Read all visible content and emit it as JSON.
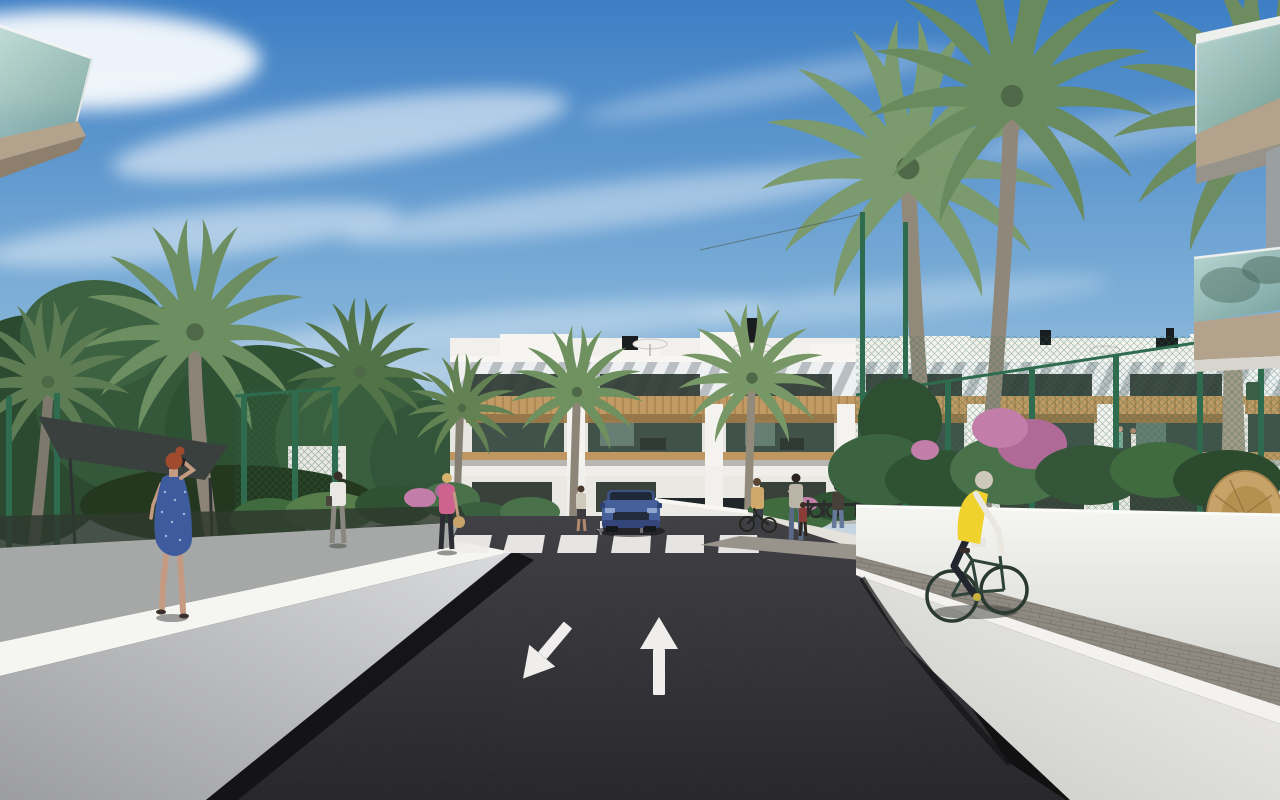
{
  "scene": {
    "type": "architectural-exterior-render",
    "description": "3D rendering of a modern white Mediterranean apartment complex seen down a dark asphalt access road. White retaining walls flank the road, palm trees and green mesh fences line both sides, a blue SUV exits a garage behind a zebra crosswalk, a cyclist in a yellow vest rides a paved path on the right, and pedestrians walk the landscaped paths.",
    "elements": [
      "blue-sky-with-cirrus-clouds",
      "apartment-building",
      "rooftop-pergola-slats",
      "wood-clad-balconies",
      "penthouse-volumes",
      "roof-umbrellas",
      "chimneys",
      "palm-trees",
      "green-mesh-fences",
      "shade-sail",
      "flowering-shrubs",
      "bougainvillea",
      "hanging-wicker-chair",
      "foreground-glass-balconies",
      "asphalt-road",
      "zebra-crosswalk",
      "lane-arrows",
      "blue-suv",
      "white-retaining-walls",
      "paver-cycle-path",
      "cyclist-yellow-vest",
      "woman-blue-dress-on-phone",
      "man-white-shirt",
      "woman-pink-top",
      "pedestrian-group-with-child",
      "woman-with-bicycle",
      "bike-racks",
      "green-bin"
    ],
    "road_markings": {
      "lane_arrows": [
        "toward-viewer-down-left",
        "away-from-viewer-up"
      ],
      "crosswalk_stripes": 6
    },
    "people_count": 9,
    "vehicles": [
      "blue-suv",
      "bicycles"
    ]
  },
  "colors": {
    "sky_top": "#3d7ec4",
    "sky_mid": "#7fb0d8",
    "sky_horizon": "#ccdae4",
    "cloud_white": "#ffffff",
    "asphalt_far": "#3b3a3e",
    "asphalt_near": "#212024",
    "road_marking_white": "#efeeec",
    "wall_bright_top": "#f5f5f2",
    "wall_face_grey": "#c9cacc",
    "paver_grey": "#8f8a82",
    "building_white": "#f1f0ec",
    "pergola_stripe_grey": "#b9bec2",
    "window_dark": "#2f3a34",
    "wood_tan": "#c29a63",
    "wood_dark": "#a07c4b",
    "balcony_interior_green": "#41524a",
    "fence_green": "#2f6b4e",
    "foliage_dark": "#2f4f33",
    "foliage_mid": "#4c7247",
    "palm_green": "#7a9c6e",
    "palm_trunk": "#91897a",
    "bougainvillea_pink": "#c27da8",
    "glass_teal_light": "#bcd8d2",
    "glass_teal_dark": "#7fa8a2",
    "fascia_beige": "#b3a28c",
    "car_blue": "#46609c",
    "car_blue_dark": "#2e4070",
    "vest_yellow": "#f0d22f",
    "dress_blue": "#3e5c9d",
    "top_pink": "#cf6390",
    "skin": "#c49a82",
    "hair_red": "#a14b2e",
    "shade_sail_grey": "#3a403d",
    "wicker_tan": "#c8a369",
    "shadow_black": "#121215"
  }
}
